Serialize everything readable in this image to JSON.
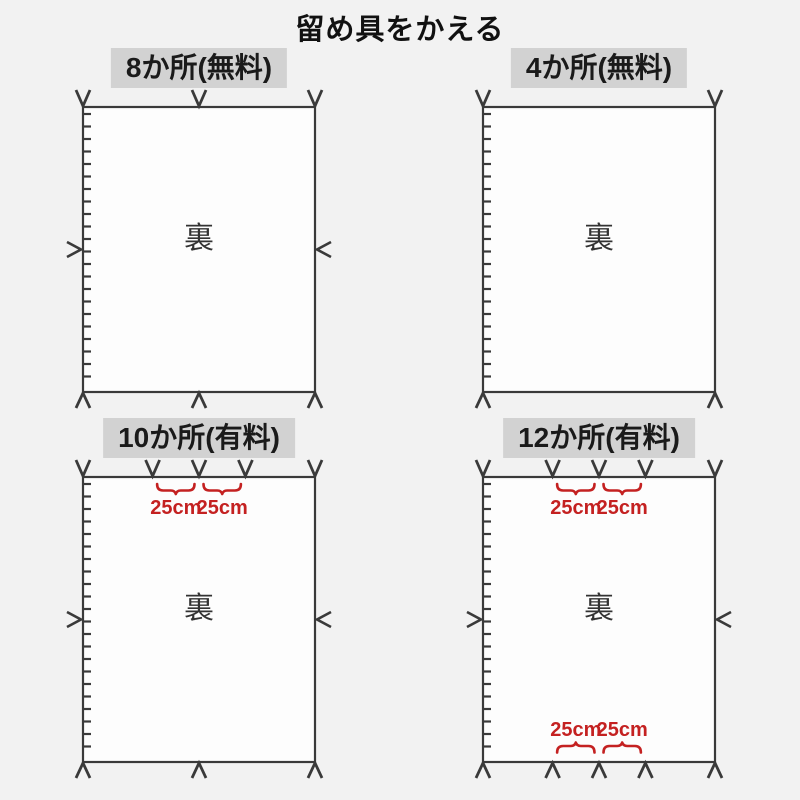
{
  "title": "留め具をかえる",
  "colors": {
    "background": "#f2f2f2",
    "fabric_fill": "#fdfdfd",
    "line": "#3a3a3a",
    "label_background": "#d2d2d2",
    "label_text": "#1a1a1a",
    "accent_red": "#c42121"
  },
  "panels": [
    {
      "id": "8-places-free",
      "label": "8か所(無料)",
      "center_text": "裏",
      "top_fasteners": [
        0,
        0.5,
        1
      ],
      "bottom_fasteners": [
        0,
        0.5,
        1
      ],
      "left_fastener": true,
      "right_fastener": true,
      "top_spacing": false,
      "bottom_spacing": false,
      "spacing_text": "25cm"
    },
    {
      "id": "4-places-free",
      "label": "4か所(無料)",
      "center_text": "裏",
      "top_fasteners": [
        0,
        1
      ],
      "bottom_fasteners": [
        0,
        1
      ],
      "left_fastener": false,
      "right_fastener": false,
      "top_spacing": false,
      "bottom_spacing": false,
      "spacing_text": "25cm"
    },
    {
      "id": "10-places-paid",
      "label": "10か所(有料)",
      "center_text": "裏",
      "top_fasteners": [
        0,
        0.3,
        0.5,
        0.7,
        1
      ],
      "bottom_fasteners": [
        0,
        0.5,
        1
      ],
      "left_fastener": true,
      "right_fastener": true,
      "top_spacing": true,
      "bottom_spacing": false,
      "spacing_text": "25cm"
    },
    {
      "id": "12-places-paid",
      "label": "12か所(有料)",
      "center_text": "裏",
      "top_fasteners": [
        0,
        0.3,
        0.5,
        0.7,
        1
      ],
      "bottom_fasteners": [
        0,
        0.3,
        0.5,
        0.7,
        1
      ],
      "left_fastener": true,
      "right_fastener": true,
      "top_spacing": true,
      "bottom_spacing": true,
      "spacing_text": "25cm"
    }
  ]
}
